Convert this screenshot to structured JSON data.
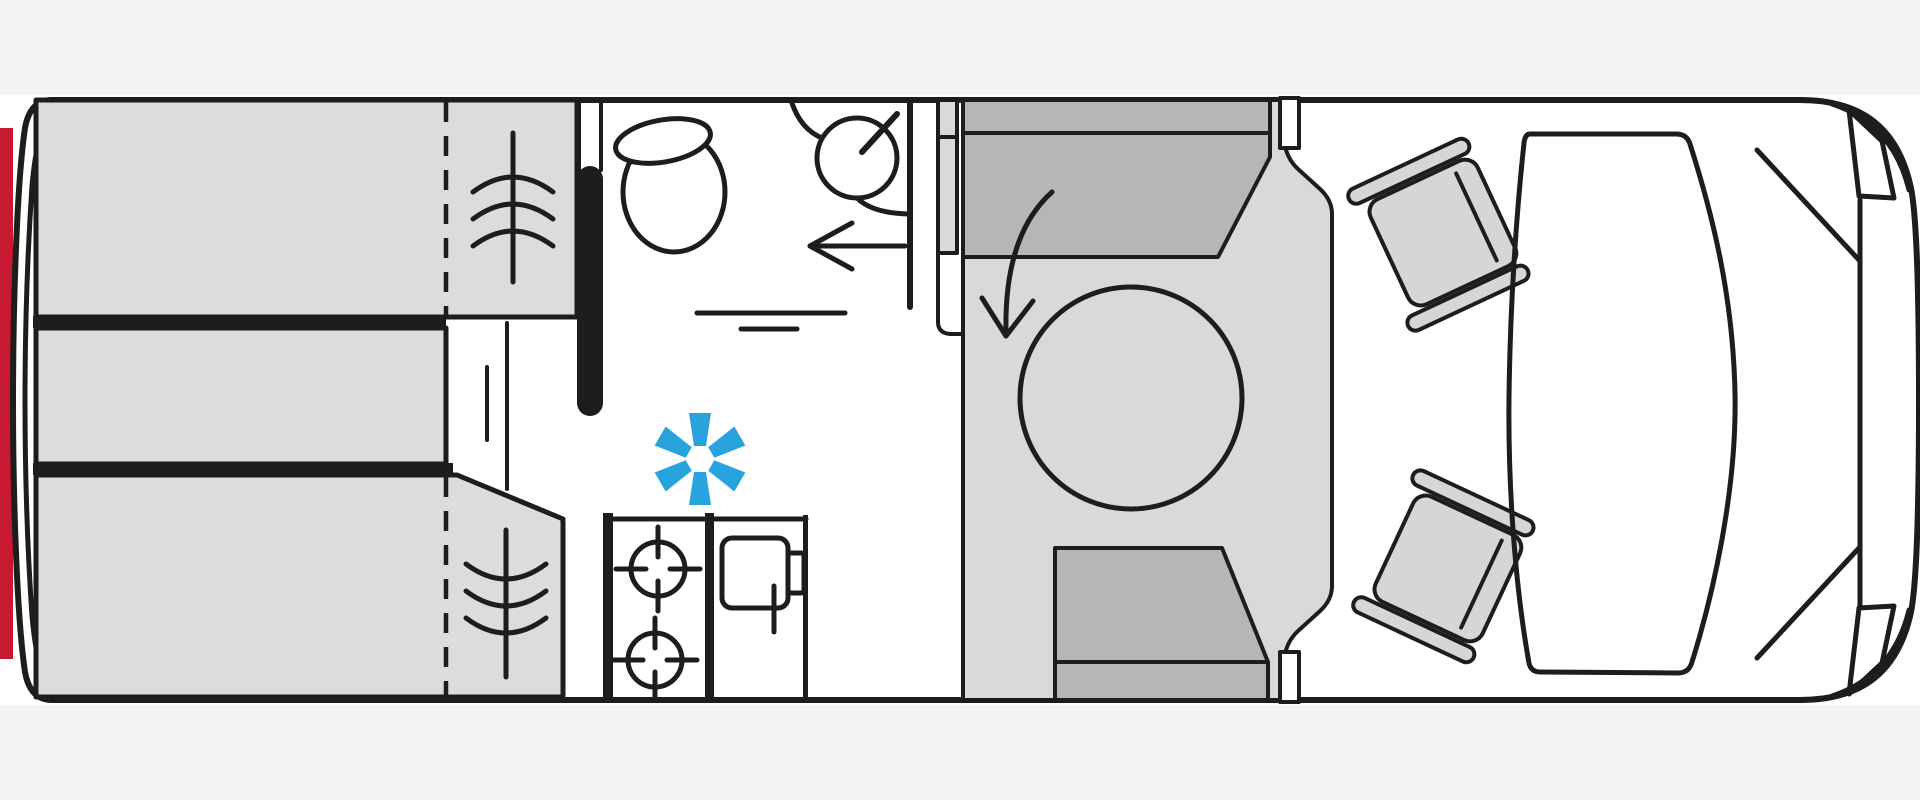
{
  "diagram": {
    "kind": "campervan-floor-plan",
    "view": "top-down",
    "orientation": "vehicle front on the right, rear on the left",
    "areas": [
      {
        "id": "rear-beds",
        "label": "rear transverse beds",
        "features": [
          "upper-bed",
          "middle-bed",
          "lower-bed",
          "fold-line-dashed",
          "slat-wave-symbol"
        ]
      },
      {
        "id": "washroom",
        "label": "washroom",
        "features": [
          "toilet",
          "corner-basin",
          "faucet",
          "entry-arrow",
          "shower-tray-lines",
          "partition-wall"
        ]
      },
      {
        "id": "kitchen",
        "label": "kitchen block",
        "features": [
          "two-burner-hob",
          "sink-bowl",
          "tap"
        ]
      },
      {
        "id": "dinette",
        "label": "half-dinette",
        "features": [
          "round-table",
          "rear-bench-seat",
          "front-bench-seat",
          "swivel-arrow",
          "side-door-pillars"
        ]
      },
      {
        "id": "cab",
        "label": "driver cab",
        "features": [
          "driver-swivel-seat",
          "passenger-swivel-seat",
          "windscreen",
          "a-pillars",
          "wing-mirrors"
        ]
      }
    ],
    "symbols": [
      {
        "id": "frost-asterisk",
        "meaning": "winter / frost symbol",
        "color": "#29a3dd"
      },
      {
        "id": "rear-accent-bar",
        "meaning": "rear accent stripe",
        "color": "#c81932"
      }
    ]
  },
  "palette": {
    "page-bg": "#ffffff",
    "band": "#f4f4f5",
    "ink": "#1d1d1b",
    "bed": "#dcdcdc",
    "floor": "#d9d9d9",
    "bench": "#b6b6b6",
    "seat": "#d6d6d6",
    "accent-red": "#c81932",
    "accent-blue": "#29a3dd"
  }
}
